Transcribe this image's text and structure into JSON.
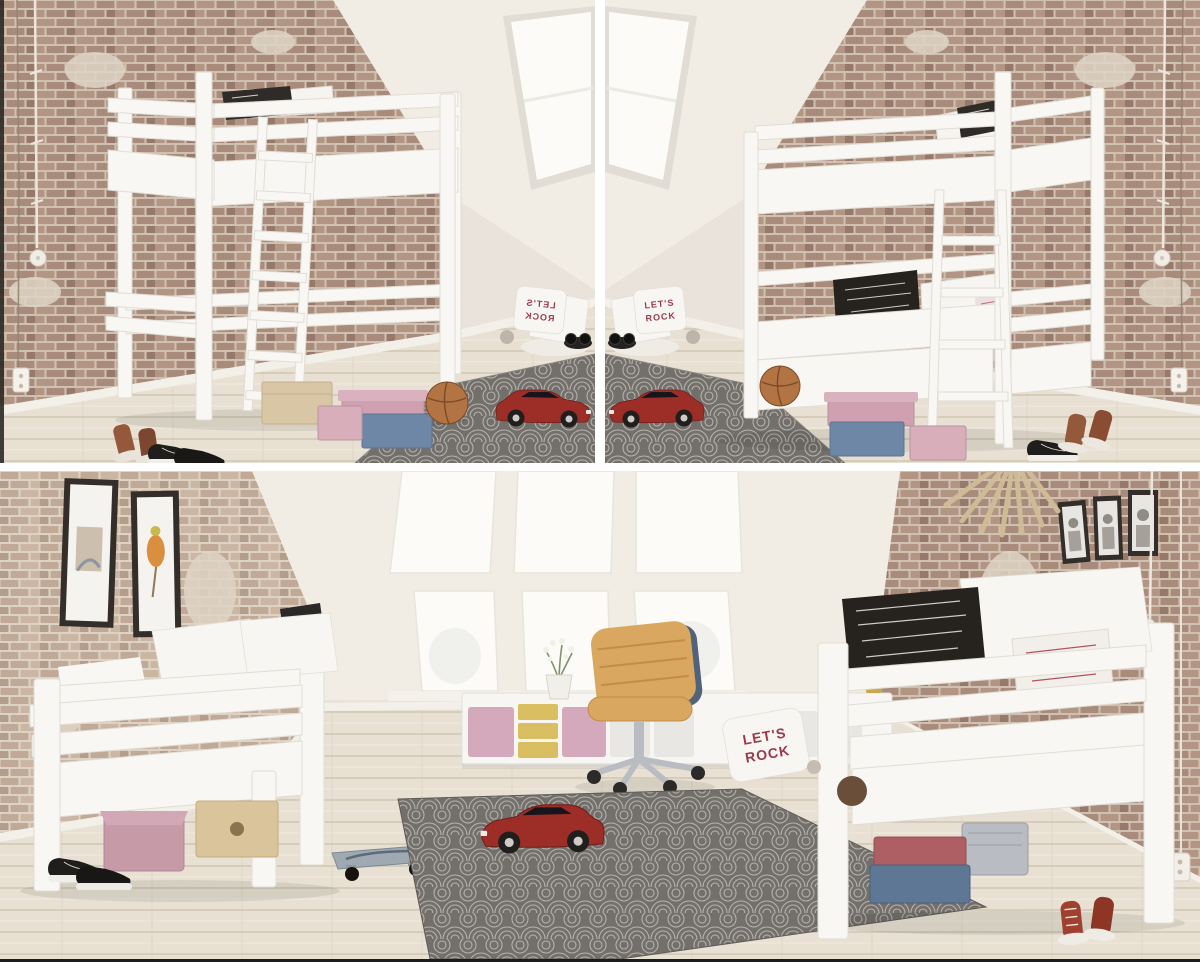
{
  "image": {
    "kind": "product-photo-collage",
    "description": "Three renders of white wooden children's beds in an attic playroom with exposed brick walls, skylight windows, wooden floor and a grey patterned rug with red toy sports cars",
    "layout": {
      "rows": 2,
      "top_panels": 2,
      "bottom_panels": 1,
      "divider_color": "#ffffff",
      "bottom_edge_color": "#1d1c1a"
    }
  },
  "text": {
    "rock_pillow_line1": "LET'S",
    "rock_pillow_line2": "ROCK"
  },
  "colors": {
    "wall": "#e9e3db",
    "wall_bright": "#f1ece4",
    "window_glow": "#fcfbf8",
    "brick": "#a98b7b",
    "brick_dark": "#97796b",
    "brick_warm": "#b39584",
    "brick_mortar": "#cfc0b2",
    "brick_light": "#c0a997",
    "brick_light_warm": "#cbb5a3",
    "brick_light_mortar": "#ddd2c3",
    "floor": "#e8e1d3",
    "floor_line": "#d0c5b2",
    "bed_white": "#f8f7f4",
    "bed_stroke": "#e1ddd5",
    "rug": "#73706c",
    "rug_pattern": "#b5b1ab",
    "car_red": "#9c2e27",
    "box_pink": "#cfa0af",
    "box_blue": "#6f87a6",
    "box_beige": "#d8c6a4",
    "box_red": "#ad5f64",
    "bin_yellow": "#d9bf62",
    "bin_pink": "#d4a9bb",
    "chair_tan": "#d9a75f",
    "chair_shell": "#51637a",
    "basketball": "#b27442",
    "text_maroon": "#9c3a4c",
    "frame_dark": "#332e29",
    "plant_green": "#7f926d",
    "skateboard_deck": "#9fa9b2",
    "shoe_black": "#201e1c",
    "shoe_brown": "#94583a",
    "shoe_red": "#a0402e",
    "bedding_green": "#3c7a50",
    "plywood": "#d9c49c",
    "metal": "#b9bcc0"
  },
  "panels": {
    "top_left": {
      "subject": "white loft bed (high sleeper) with front ladder, mirrored attic room",
      "objects": [
        "loft bed",
        "ladder",
        "print pillow on mattress",
        "brick wall",
        "sloped white ceiling",
        "skylight window",
        "beige box",
        "pink boxes",
        "blue box",
        "basketball",
        "brown boots",
        "black sneakers",
        "corner pillows with ROCK print",
        "grey patterned rug",
        "red toy sports car",
        "hanging cords",
        "wall socket"
      ]
    },
    "top_right": {
      "subject": "white bunk bed with side ladder",
      "objects": [
        "bunk bed",
        "ladder",
        "print pillows on lower bunk",
        "print pillow on top bunk",
        "brick wall",
        "sloped white ceiling",
        "skylight window",
        "pink boxes",
        "blue box",
        "basketball",
        "black sneakers",
        "red-brown high-top sneakers",
        "corner pillows with ROCK print",
        "grey patterned rug",
        "red toy sports car",
        "hanging cords",
        "wall socket"
      ]
    },
    "bottom": {
      "subject": "two white low junior beds with guard rails in attic room",
      "objects": [
        "left single bed",
        "green bedding",
        "white pillows",
        "right single bed",
        "print pillows",
        "LET'S ROCK floor pillow",
        "six-pane window wall",
        "two framed artworks",
        "three small photo frames",
        "wooden fan wall decor",
        "white storage unit with pink and yellow bins",
        "tan desk chair on castors",
        "potted plant",
        "skateboard",
        "grey patterned rug",
        "red toy sports car",
        "plywood box",
        "pink fabric box",
        "blue box",
        "dusty-red box",
        "grey basket",
        "black sneakers",
        "red high-top sneakers",
        "hanging cable with pendant",
        "wall socket"
      ]
    }
  }
}
